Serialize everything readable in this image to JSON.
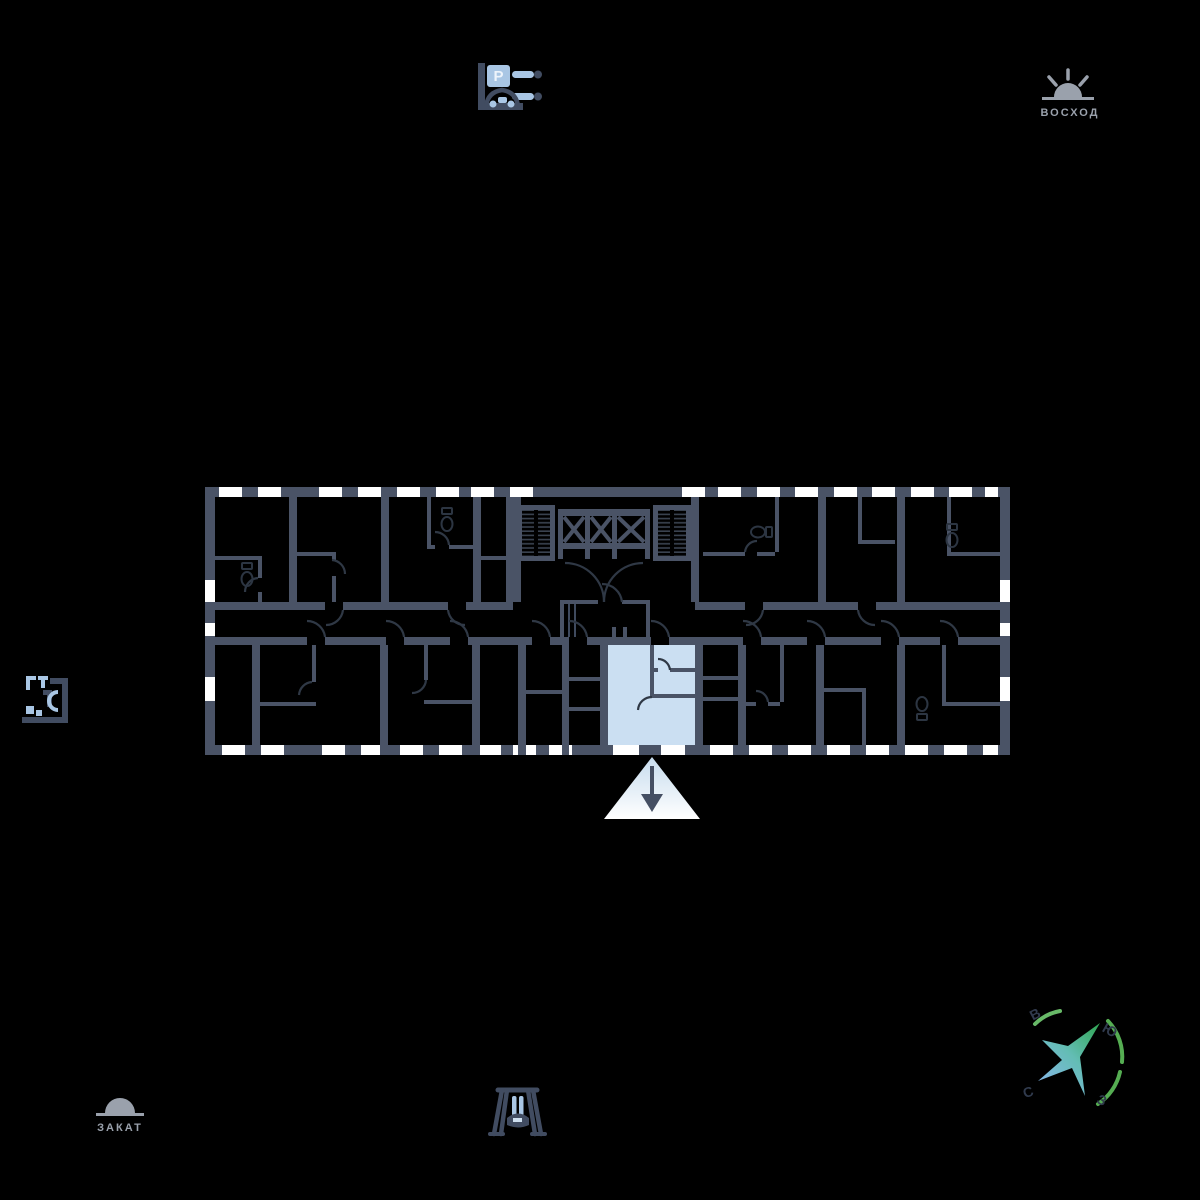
{
  "page": {
    "type": "apartment-floorplan-view",
    "background_color": "#000000"
  },
  "floorplan": {
    "wall_color": "#4a5366",
    "window_color": "#ffffff",
    "detail_color": "#2f3845",
    "selected_apartment": {
      "highlight_color": "#cbdff2",
      "position": "bottom-center",
      "rooms": 3,
      "entrance_from": "corridor"
    },
    "entrance_marker": {
      "shape": "triangle-beam",
      "direction": "down",
      "arrow_color": "#454f63"
    },
    "core": {
      "elevators": 3,
      "stairwells": 2
    }
  },
  "icons": {
    "parking": {
      "letter": "P",
      "accent_color": "#a9c6e4",
      "frame_color": "#414c61"
    },
    "sunrise": {
      "label": "ВОСХОД",
      "color": "#9aa1ac"
    },
    "sunset": {
      "label": "ЗАКАТ",
      "color": "#9aa1ac"
    },
    "mini_floorplan": {
      "accent_color": "#a9c6e4"
    },
    "swing": {
      "accent_color": "#a9c6e4"
    },
    "compass": {
      "letters": {
        "north": "С",
        "south": "Ю",
        "east": "В",
        "west": "З"
      },
      "star_gradient": [
        "#84b7e6",
        "#2fa551"
      ],
      "arc_color": "#55ad52"
    }
  }
}
